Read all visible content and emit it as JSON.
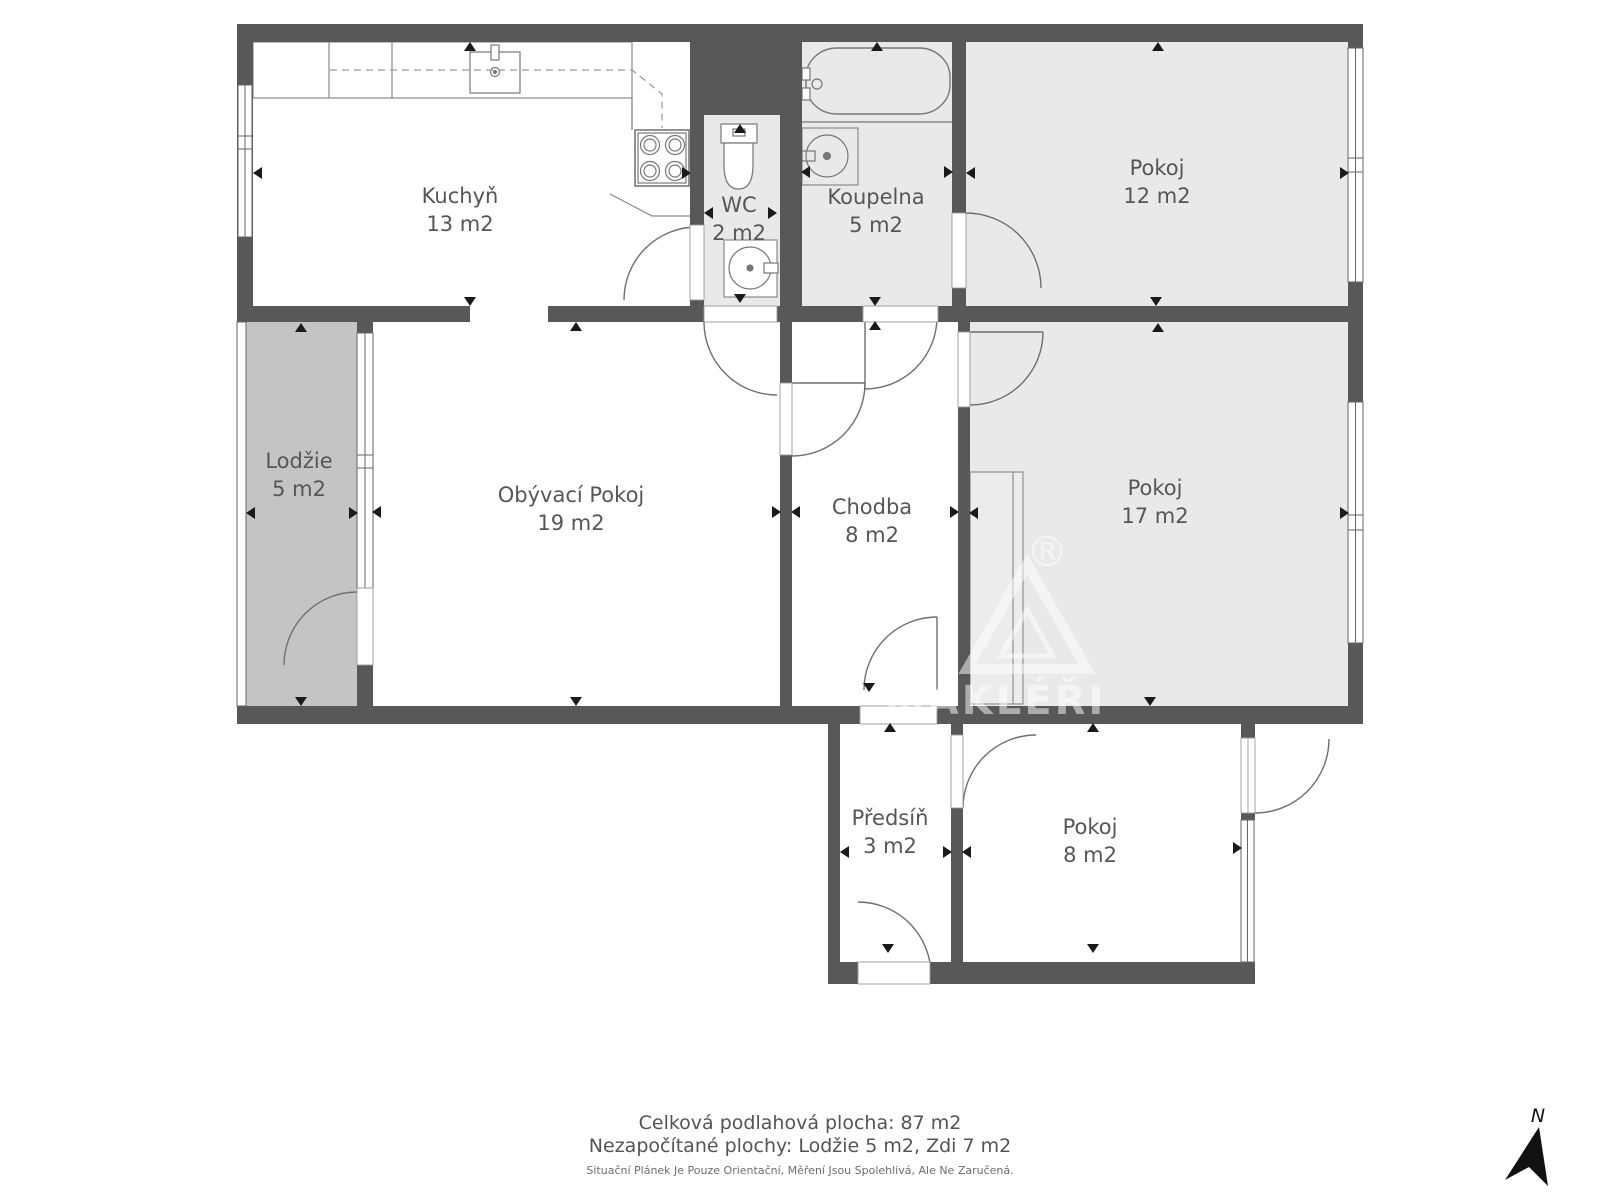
{
  "plan": {
    "rooms": [
      {
        "id": "kuchyn",
        "name": "Kuchyň",
        "area": "13 m2"
      },
      {
        "id": "wc",
        "name": "WC",
        "area": "2 m2"
      },
      {
        "id": "koupelna",
        "name": "Koupelna",
        "area": "5 m2"
      },
      {
        "id": "pokoj-12",
        "name": "Pokoj",
        "area": "12 m2"
      },
      {
        "id": "lodzie",
        "name": "Lodžie",
        "area": "5 m2"
      },
      {
        "id": "obyvaci",
        "name": "Obývací Pokoj",
        "area": "19 m2"
      },
      {
        "id": "chodba",
        "name": "Chodba",
        "area": "8 m2"
      },
      {
        "id": "pokoj-17",
        "name": "Pokoj",
        "area": "17 m2"
      },
      {
        "id": "predsin",
        "name": "Předsíň",
        "area": "3 m2"
      },
      {
        "id": "pokoj-8",
        "name": "Pokoj",
        "area": "8 m2"
      }
    ]
  },
  "summary": {
    "total": "Celková podlahová plocha: 87 m2",
    "excluded": "Nezapočítané plochy: Lodžie 5 m2, Zdi 7 m2",
    "disclaimer": "Situační Plánek Je Pouze Orientační, Měření Jsou Spolehlivá, Ale Ne Zaručená."
  },
  "watermark": {
    "text": "MAKLÉŘI",
    "symbol": "®"
  },
  "compass": {
    "north_label": "N"
  },
  "colors": {
    "wall": "#58585a",
    "floor_light": "#e9e9e9",
    "floor_loggia": "#c4c4c4",
    "fixture_line": "#777777",
    "label_text": "#565656",
    "marker": "#1a1a1a",
    "watermark": "#ffffff"
  }
}
